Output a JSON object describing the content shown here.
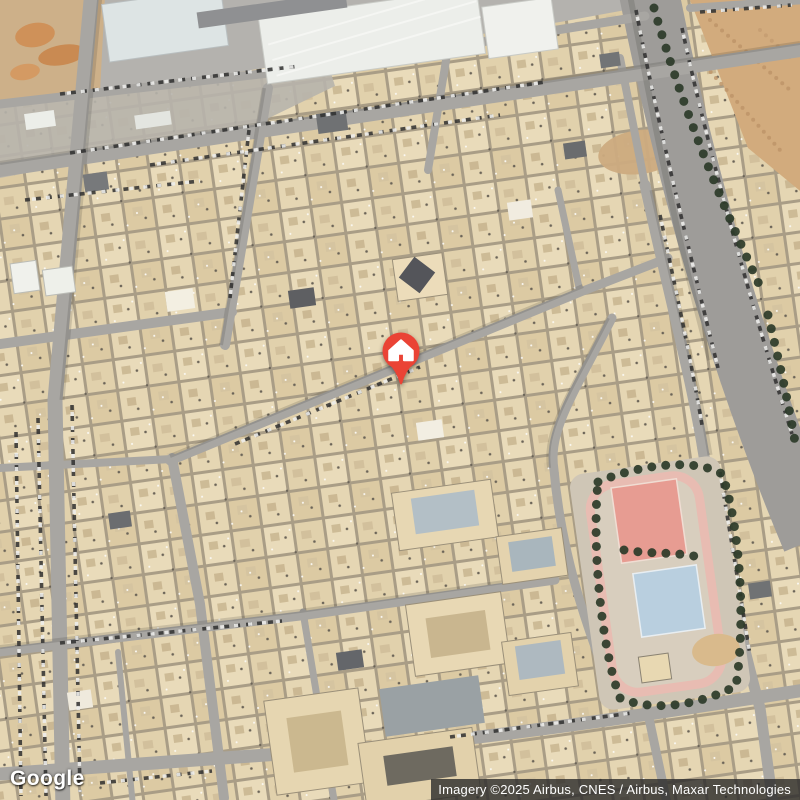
{
  "map": {
    "view_type": "satellite",
    "provider_logo": "Google",
    "attribution": "Imagery ©2025 Airbus, CNES / Airbus, Maxar Technologies",
    "marker": {
      "icon": "home-icon",
      "pin_color": "#EA4335",
      "glyph_color": "#FFFFFF"
    },
    "palette": {
      "road": "#a8a6a2",
      "avenue": "#9e9c99",
      "block_base": "#a99d86",
      "roof_light": "#e9dbba",
      "sand": "#d2ab7d",
      "dirt_orange": "#cf9159",
      "tree": "#2d3b29",
      "park_track": "#e8bcb2",
      "court_red": "#e79c92",
      "court_blue": "#b9cfdf",
      "industrial_roof": "#eceeea",
      "attribution_bg": "#2a2a2a",
      "attribution_text": "#ffffff",
      "logo_text": "#ffffff"
    }
  }
}
